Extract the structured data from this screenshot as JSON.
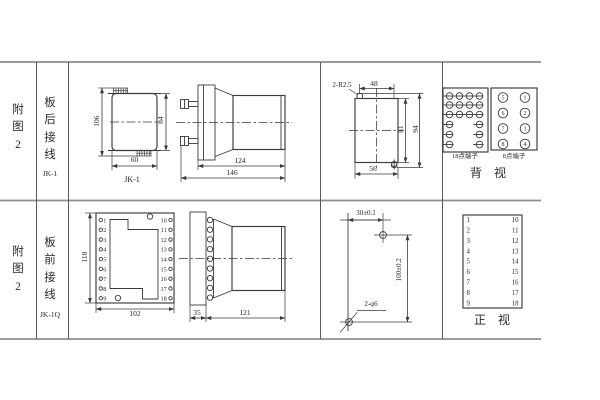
{
  "colors": {
    "line": "#3a3a3a",
    "table_line": "#8d8d8d",
    "background": "#ffffff"
  },
  "row1": {
    "fig_label": "附图2",
    "wiring_label": "板后接线",
    "model": "JK-1",
    "front_view": {
      "total_height": "106",
      "cover_height": "84",
      "width": "60",
      "caption": "JK-1"
    },
    "side_view": {
      "body_length": "124",
      "total_length": "146"
    },
    "cutout": {
      "corner_note": "2-R2.5",
      "hole_span": "48",
      "inner_height": "81",
      "outer_height": "94",
      "width": "56"
    },
    "rear_view": {
      "label_18": "18点端子",
      "label_8": "8点端子",
      "caption": "背　视",
      "circle_left": [
        "5",
        "6",
        "7",
        "8"
      ],
      "circle_right": [
        "1",
        "2",
        "3",
        "4"
      ]
    }
  },
  "row2": {
    "fig_label": "附图2",
    "wiring_label": "板前接线",
    "model": "JK-1Q",
    "front_view": {
      "height": "118",
      "width": "102",
      "left_terminals": [
        "1",
        "2",
        "3",
        "4",
        "5",
        "6",
        "7",
        "8",
        "9"
      ],
      "right_terminals": [
        "10",
        "11",
        "12",
        "13",
        "14",
        "15",
        "16",
        "17",
        "18"
      ]
    },
    "side_view": {
      "plate_depth": "35",
      "body_length": "121"
    },
    "drill_plan": {
      "hole_pitch_x": "30±0.1",
      "hole_pitch_y": "100±0.2",
      "hole_note": "2-φ6"
    },
    "front_panel": {
      "left_terminals": [
        "1",
        "2",
        "3",
        "4",
        "5",
        "6",
        "7",
        "8",
        "9"
      ],
      "right_terminals": [
        "10",
        "11",
        "12",
        "13",
        "14",
        "15",
        "16",
        "17",
        "18"
      ],
      "caption": "正　视"
    }
  }
}
